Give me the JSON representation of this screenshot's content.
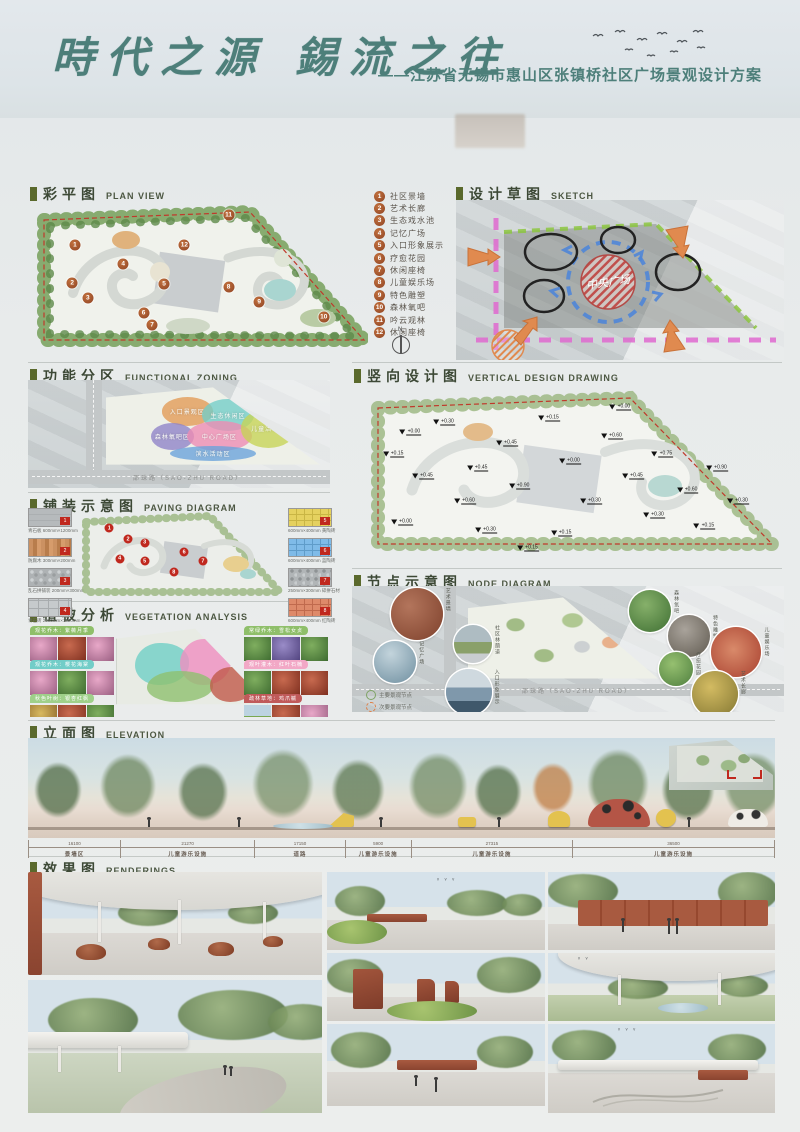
{
  "header": {
    "title": "時代之源 錫流之往",
    "subtitle": "——江苏省无锡市惠山区张镇桥社区广场景观设计方案"
  },
  "sections": {
    "plan_view": {
      "zh": "彩平图",
      "en": "PLAN VIEW"
    },
    "sketch": {
      "zh": "设计草图",
      "en": "SKETCH"
    },
    "zoning": {
      "zh": "功能分区",
      "en": "FUNCTIONAL ZONING"
    },
    "vertical": {
      "zh": "竖向设计图",
      "en": "VERTICAL DESIGN DRAWING"
    },
    "paving": {
      "zh": "铺装示意图",
      "en": "PAVING DIAGRAM"
    },
    "node": {
      "zh": "节点示意图",
      "en": "NODE DIAGRAM"
    },
    "vegetation": {
      "zh": "植被分析",
      "en": "VEGETATION ANALYSIS"
    },
    "elevation": {
      "zh": "立面图",
      "en": "ELEVATION"
    },
    "renderings": {
      "zh": "效果图",
      "en": "RENDERINGS"
    }
  },
  "plan_view": {
    "compass_label": "N",
    "legend": [
      {
        "n": "1",
        "label": "社区景墙"
      },
      {
        "n": "2",
        "label": "艺术长廊"
      },
      {
        "n": "3",
        "label": "生态戏水池"
      },
      {
        "n": "4",
        "label": "记忆广场"
      },
      {
        "n": "5",
        "label": "入口形象展示"
      },
      {
        "n": "6",
        "label": "疗愈花园"
      },
      {
        "n": "7",
        "label": "休闲座椅"
      },
      {
        "n": "8",
        "label": "儿童娱乐场"
      },
      {
        "n": "9",
        "label": "特色雕塑"
      },
      {
        "n": "10",
        "label": "森林氧吧"
      },
      {
        "n": "11",
        "label": "吟云观林"
      },
      {
        "n": "12",
        "label": "休闲座椅"
      }
    ],
    "markers": [
      {
        "n": "1",
        "x": 13.8,
        "y": 30
      },
      {
        "n": "2",
        "x": 13,
        "y": 54
      },
      {
        "n": "3",
        "x": 17.6,
        "y": 64
      },
      {
        "n": "4",
        "x": 28,
        "y": 42
      },
      {
        "n": "5",
        "x": 40,
        "y": 55
      },
      {
        "n": "6",
        "x": 34,
        "y": 73
      },
      {
        "n": "7",
        "x": 36.5,
        "y": 81
      },
      {
        "n": "8",
        "x": 59,
        "y": 57
      },
      {
        "n": "9",
        "x": 68,
        "y": 66
      },
      {
        "n": "10",
        "x": 87,
        "y": 76
      },
      {
        "n": "11",
        "x": 59,
        "y": 11
      },
      {
        "n": "12",
        "x": 46,
        "y": 30
      }
    ]
  },
  "sketch": {
    "center_label": "中央广场"
  },
  "zoning": {
    "road_label": "邵珠路（SAO-ZHU ROAD）",
    "zones": [
      {
        "label": "入口景观区",
        "color": "#e39a55",
        "x": 26,
        "y": 16,
        "w": 24,
        "h": 34
      },
      {
        "label": "生态休闲区",
        "color": "#72cdc8",
        "x": 45,
        "y": 18,
        "w": 24,
        "h": 38
      },
      {
        "label": "森林氧吧区",
        "color": "#8f83c9",
        "x": 21,
        "y": 46,
        "w": 20,
        "h": 32
      },
      {
        "label": "中心广场区",
        "color": "#ef8cb4",
        "x": 38,
        "y": 44,
        "w": 30,
        "h": 36
      },
      {
        "label": "滨水活动区",
        "color": "#6aa3dc",
        "x": 30,
        "y": 74,
        "w": 40,
        "h": 18
      },
      {
        "label": "儿童活动区",
        "color": "#c7d455",
        "x": 63,
        "y": 30,
        "w": 26,
        "h": 46
      }
    ]
  },
  "vertical": {
    "spots": [
      {
        "v": "+0.00",
        "x": 12,
        "y": 28
      },
      {
        "v": "+0.30",
        "x": 20,
        "y": 22
      },
      {
        "v": "+0.15",
        "x": 8,
        "y": 40
      },
      {
        "v": "+0.45",
        "x": 15,
        "y": 52
      },
      {
        "v": "+0.60",
        "x": 25,
        "y": 66
      },
      {
        "v": "+0.00",
        "x": 10,
        "y": 78
      },
      {
        "v": "+0.30",
        "x": 30,
        "y": 82
      },
      {
        "v": "+0.90",
        "x": 38,
        "y": 58
      },
      {
        "v": "+0.45",
        "x": 35,
        "y": 34
      },
      {
        "v": "+0.15",
        "x": 45,
        "y": 20
      },
      {
        "v": "+0.00",
        "x": 50,
        "y": 44
      },
      {
        "v": "+0.30",
        "x": 55,
        "y": 66
      },
      {
        "v": "+0.15",
        "x": 48,
        "y": 84
      },
      {
        "v": "+0.60",
        "x": 60,
        "y": 30
      },
      {
        "v": "+0.45",
        "x": 65,
        "y": 52
      },
      {
        "v": "+0.30",
        "x": 70,
        "y": 74
      },
      {
        "v": "+0.75",
        "x": 72,
        "y": 40
      },
      {
        "v": "+0.60",
        "x": 78,
        "y": 60
      },
      {
        "v": "+0.15",
        "x": 82,
        "y": 80
      },
      {
        "v": "+0.90",
        "x": 85,
        "y": 48
      },
      {
        "v": "+0.30",
        "x": 90,
        "y": 66
      },
      {
        "v": "+0.00",
        "x": 62,
        "y": 14
      },
      {
        "v": "+0.15",
        "x": 40,
        "y": 92
      },
      {
        "v": "+0.45",
        "x": 28,
        "y": 48
      }
    ]
  },
  "paving": {
    "left": [
      {
        "n": "1",
        "caption": "青石板 600mm×1200mm",
        "sw": "sw-stone"
      },
      {
        "n": "2",
        "caption": "防腐木 300mm×200mm",
        "sw": "sw-wood"
      },
      {
        "n": "3",
        "caption": "乱石拼铺装 200mm×300mm",
        "sw": "sw-pebble"
      },
      {
        "n": "4",
        "caption": "青石砖 2000mm×1500mm",
        "sw": "sw-tile"
      }
    ],
    "right": [
      {
        "n": "5",
        "caption": "600mm×400mm 黄陶砖",
        "sw": "sw-yellow"
      },
      {
        "n": "6",
        "caption": "600mm×400mm 蓝陶砖",
        "sw": "sw-blue"
      },
      {
        "n": "7",
        "caption": "250mm×300mm 碎拼石材",
        "sw": "sw-gravel"
      },
      {
        "n": "8",
        "caption": "600mm×400mm 红陶砖",
        "sw": "sw-red"
      }
    ],
    "dots": [
      {
        "n": "1",
        "x": 16,
        "y": 22
      },
      {
        "n": "2",
        "x": 25,
        "y": 34
      },
      {
        "n": "3",
        "x": 33,
        "y": 38
      },
      {
        "n": "4",
        "x": 21,
        "y": 55
      },
      {
        "n": "5",
        "x": 33,
        "y": 58
      },
      {
        "n": "6",
        "x": 52,
        "y": 48
      },
      {
        "n": "7",
        "x": 61,
        "y": 58
      },
      {
        "n": "8",
        "x": 47,
        "y": 70
      }
    ]
  },
  "node": {
    "road_label": "邵珠路（SAO-ZHU ROAD）",
    "legend": [
      {
        "label": "主要景观节点"
      },
      {
        "label": "次要景观节点"
      }
    ],
    "nodes": [
      {
        "label": "艺术景墙",
        "x": 15,
        "y": 22,
        "r": 26,
        "g": "g-brown"
      },
      {
        "label": "记忆广场",
        "x": 10,
        "y": 60,
        "r": 21,
        "g": "g-water"
      },
      {
        "label": "社区林荫道",
        "x": 28,
        "y": 46,
        "r": 19,
        "g": "g-alley"
      },
      {
        "label": "入口形象展示",
        "x": 27,
        "y": 84,
        "r": 23,
        "g": "g-gate"
      },
      {
        "label": "森林氧吧",
        "x": 69,
        "y": 20,
        "r": 21,
        "g": "g-forest"
      },
      {
        "label": "特色雕塑",
        "x": 78,
        "y": 40,
        "r": 21,
        "g": "g-rock"
      },
      {
        "label": "儿童娱乐场",
        "x": 89,
        "y": 52,
        "r": 25,
        "g": "g-track"
      },
      {
        "label": "疗愈花园",
        "x": 75,
        "y": 66,
        "r": 17,
        "g": "g-garden"
      },
      {
        "label": "艺术长廊",
        "x": 84,
        "y": 86,
        "r": 23,
        "g": "g-autumn"
      }
    ]
  },
  "vegetation": {
    "tags": [
      {
        "label": "观花乔木：紫薇月季",
        "color": "#8fbf6a",
        "photos": [
          "vp-blossom",
          "vp-red",
          "vp-blossom"
        ]
      },
      {
        "label": "观花乔木：樱花海棠",
        "color": "#72cdc8",
        "photos": [
          "vp-blossom",
          "vp-green",
          "vp-blossom"
        ]
      },
      {
        "label": "秋色叶树：银杏红枫",
        "color": "#9fd08a",
        "photos": [
          "vp-autumn",
          "vp-red",
          "vp-green"
        ]
      },
      {
        "label": "常绿乔木：雪松女贞",
        "color": "#8fbf6a",
        "photos": [
          "vp-green",
          "vp-purple",
          "vp-green"
        ]
      },
      {
        "label": "观叶灌木：红叶石楠",
        "color": "#f2a8c6",
        "photos": [
          "vp-green",
          "vp-red",
          "vp-red"
        ]
      },
      {
        "label": "疏林草地：鸡爪槭",
        "color": "#c05a5a",
        "photos": [
          "vp-lawn",
          "vp-red",
          "vp-blossom"
        ]
      }
    ]
  },
  "elevation": {
    "segments": [
      {
        "dim": "16100",
        "label": "景墙区"
      },
      {
        "dim": "21270",
        "label": "儿童游乐设施"
      },
      {
        "dim": "17150",
        "label": "道路"
      },
      {
        "dim": "5900",
        "label": "儿童游乐设施"
      },
      {
        "dim": "27315",
        "label": "儿童游乐设施"
      },
      {
        "dim": "36500",
        "label": "儿童游乐设施"
      }
    ]
  }
}
